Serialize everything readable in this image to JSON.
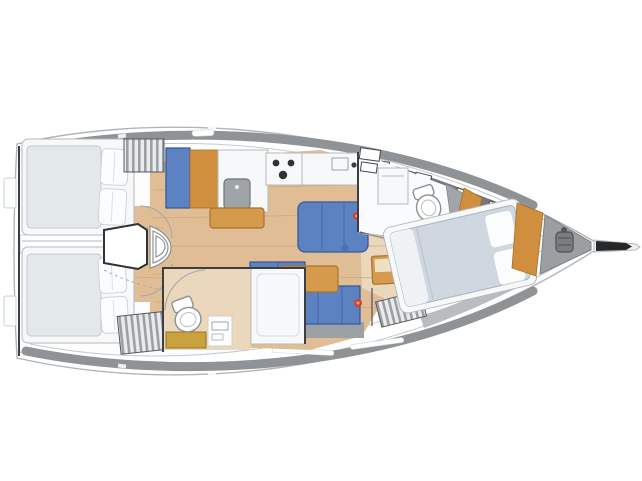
{
  "figure": {
    "type": "sailing-yacht-interior-floor-plan",
    "orientation": "bow-right",
    "regions": [
      "aft-cabin-port",
      "aft-cabin-starboard",
      "companionway-steps",
      "galley",
      "salon",
      "aft-head",
      "forward-head",
      "forward-cabin",
      "anchor-locker",
      "bowsprit"
    ],
    "icons": [
      "stove-icon",
      "sink-icon",
      "toilet-icon",
      "windlass-icon",
      "hanging-locker-icon",
      "mast-icon"
    ]
  },
  "palette": {
    "hullStroke": "#b2b5b7",
    "innerStroke": "#c6c9cb",
    "deckGray": "#8f9396",
    "coachroofGray": "#75797d",
    "wood": "#e0bd95",
    "woodLight": "#ead7bc",
    "woodLine": "#d2a87c",
    "settee": "#5d82c1",
    "setteeDark": "#37599b",
    "tableWood": "#d59a4b",
    "tableWoodEdge": "#a5732c",
    "orangeDoor": "#cf8f3f",
    "gold": "#c9a23e",
    "goldEdge": "#97741f",
    "mattress": "#e3e8ea",
    "fwdMattress": "#cfd8e0",
    "pillow": "#fbfcfd",
    "sinkGray": "#9fa4a8",
    "darkLine": "#3b3f42",
    "grayBase": "#9aa0a3",
    "showerGray": "#a2a6a9",
    "redDot": "#d2452f",
    "blueDot": "#4a6fb5",
    "bowsprit": "#26282a",
    "anchorGray": "#797d80",
    "floorShadow": "#b9bdc0"
  }
}
